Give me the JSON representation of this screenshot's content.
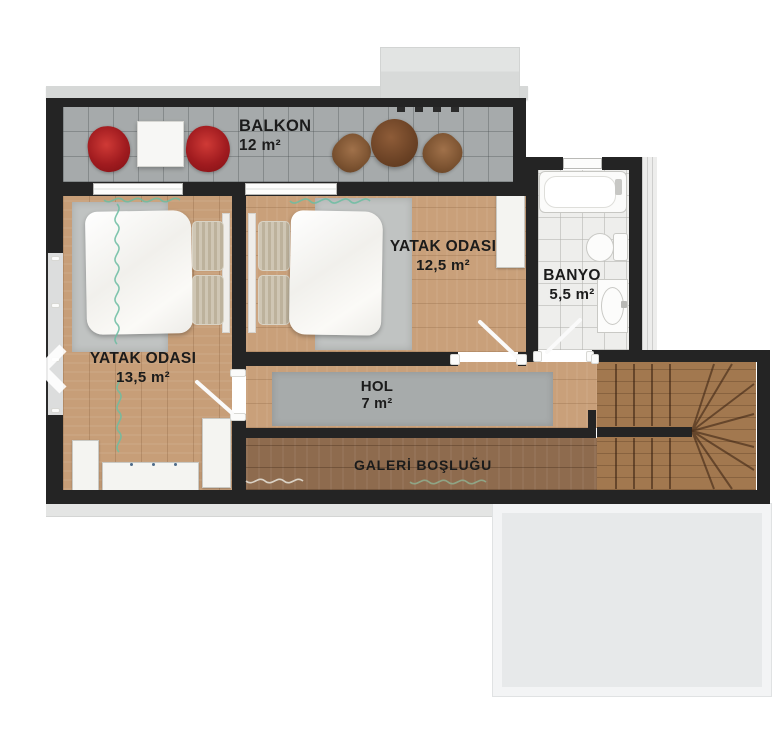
{
  "plan": {
    "rooms": {
      "balkon": {
        "name": "BALKON",
        "area": "12 m²"
      },
      "bedroom_mid": {
        "name": "YATAK ODASI",
        "area": "12,5 m²"
      },
      "banyo": {
        "name": "BANYO",
        "area": "5,5 m²"
      },
      "bedroom_left": {
        "name": "YATAK ODASI",
        "area": "13,5 m²"
      },
      "hol": {
        "name": "HOL",
        "area": "7 m²"
      },
      "galeri": {
        "name": "GALERİ BOŞLUĞU"
      }
    },
    "colors": {
      "wall": "#242424",
      "wood_light": "#c79e78",
      "wood_gallery": "#8e6b4e",
      "wood_stairs": "#a2784f",
      "balcony_tile": "#a6aaab",
      "bathroom_tile": "#eeeeec",
      "rug_gray": "#c0c3c2",
      "hall_rug": "#a7abab",
      "chair_red": "#b01f24",
      "table_brown": "#7b4b2d",
      "roof_gray": "#e7e9ea"
    },
    "icons": {
      "carousel_prev": "chevron-left"
    }
  }
}
